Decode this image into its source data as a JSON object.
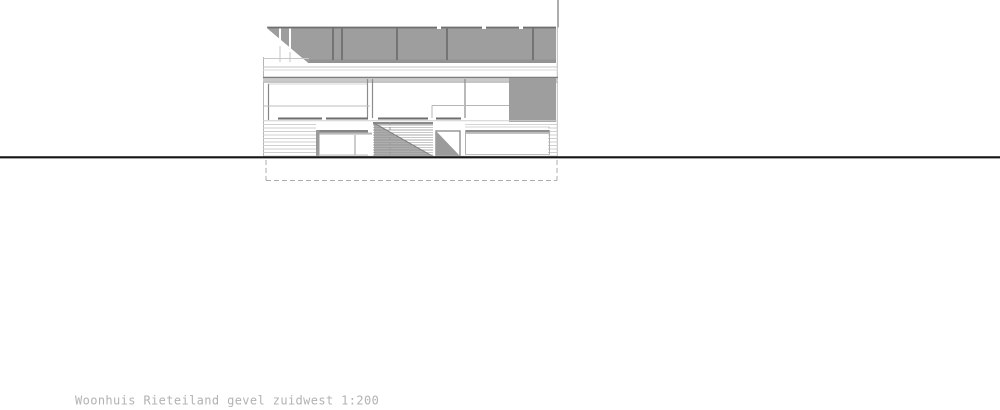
{
  "caption": {
    "text": "Woonhuis Rieteiland gevel zuidwest 1:200"
  },
  "drawing": {
    "type": "architectural-elevation",
    "subject": "Woonhuis Rieteiland",
    "view": "gevel zuidwest",
    "scale": "1:200"
  },
  "colors": {
    "shadow_gray": "#9e9e9e",
    "line_dark": "#6f6f6f",
    "line_light": "#c9c9c9",
    "ground": "#141414",
    "caption": "#b2b2b2",
    "background": "#ffffff"
  }
}
